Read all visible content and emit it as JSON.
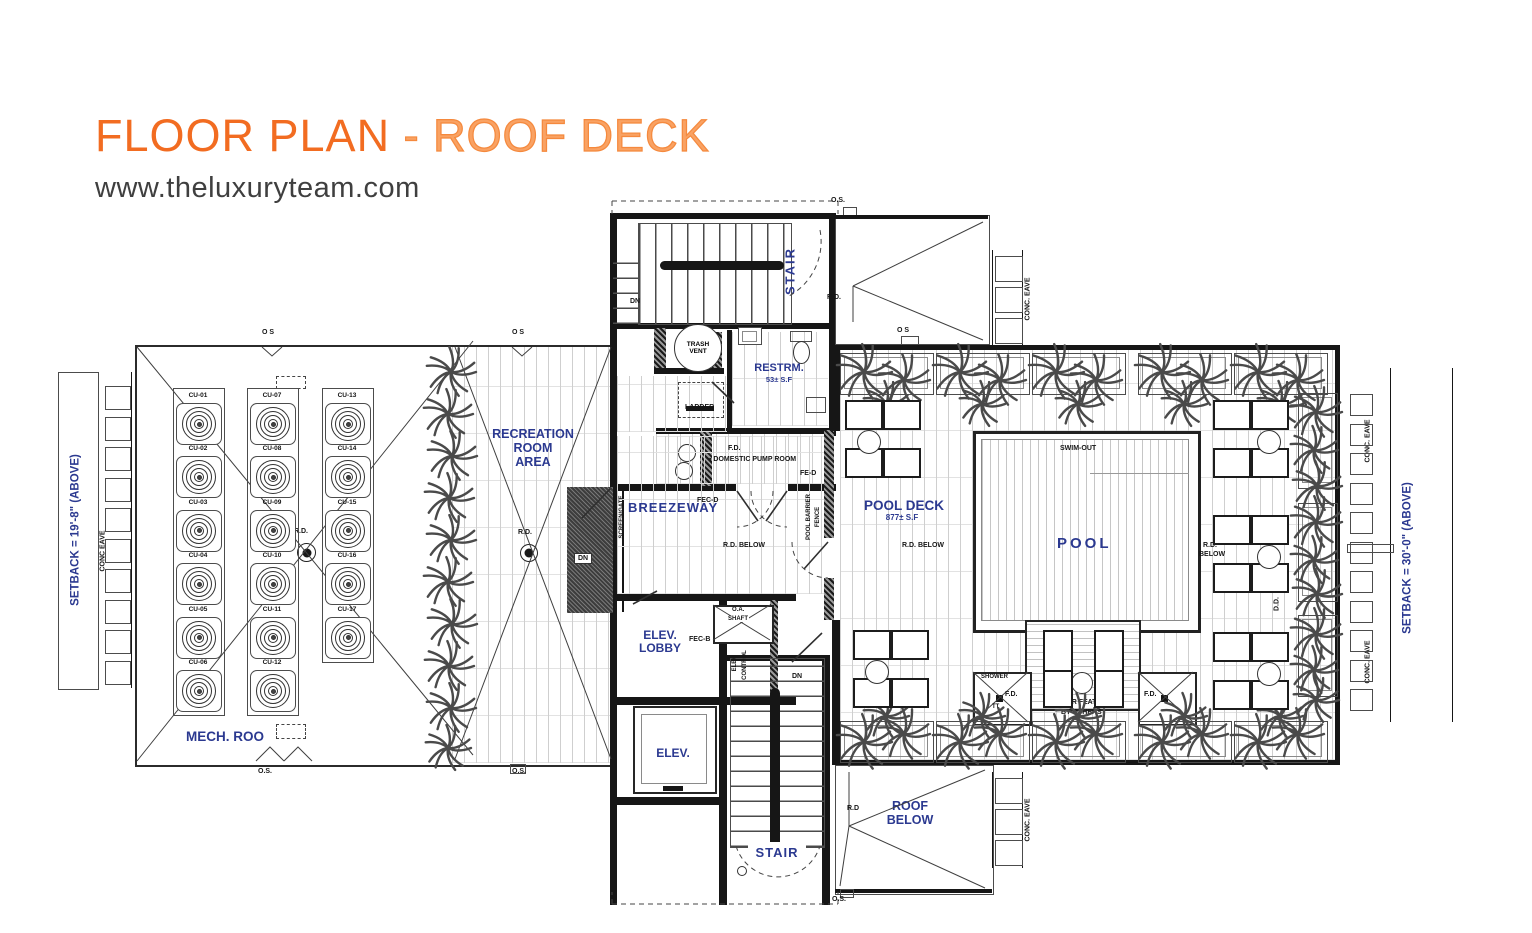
{
  "header": {
    "title_main": "FLOOR PLAN",
    "title_sub": " - ROOF DECK",
    "website": "www.theluxuryteam.com"
  },
  "colors": {
    "accent_orange": "#F26C21",
    "label_blue": "#2B3990",
    "line_dark": "#1A1A1A"
  },
  "labels": {
    "stair_top": "STAIR",
    "stair_bottom": "STAIR",
    "restrm": "RESTRM.",
    "restrm_area": "53± S.F",
    "recreation1": "RECREATION",
    "recreation2": "ROOM",
    "recreation3": "AREA",
    "breezeway": "BREEZEWAY",
    "elev_lobby1": "ELEV.",
    "elev_lobby2": "LOBBY",
    "elev": "ELEV.",
    "pool_deck": "POOL DECK",
    "pool_deck_area": "877± S.F",
    "pool": "POOL",
    "roof_below1": "ROOF",
    "roof_below2": "BELOW",
    "mech": "MECH. ROO",
    "setback_left": "SETBACK  =  19'-8\" (ABOVE)",
    "setback_right": "SETBACK = 30'-0\" (ABOVE)",
    "trash1": "TRASH",
    "trash2": "VENT"
  },
  "plan": {
    "annotations": [
      {
        "t": "O S",
        "x": 262,
        "y": 329
      },
      {
        "t": "O S",
        "x": 512,
        "y": 329
      },
      {
        "t": "O.S.",
        "x": 258,
        "y": 768
      },
      {
        "t": "O.S.",
        "x": 512,
        "y": 768
      },
      {
        "t": "R.D.",
        "x": 294,
        "y": 528
      },
      {
        "t": "R.D.",
        "x": 518,
        "y": 529
      },
      {
        "t": "DN",
        "x": 630,
        "y": 298
      },
      {
        "t": "O.S.",
        "x": 831,
        "y": 197
      },
      {
        "t": "R.D.",
        "x": 827,
        "y": 294
      },
      {
        "t": "O S",
        "x": 897,
        "y": 327
      },
      {
        "t": "CONC. EAVE",
        "cx": 1028,
        "cy": 299
      },
      {
        "t": "CONC. EAVE",
        "cx": 1028,
        "cy": 820
      },
      {
        "t": "CONC EAVE",
        "cx": 103,
        "cy": 551
      },
      {
        "t": "CONC. EAVE",
        "cx": 1368,
        "cy": 441
      },
      {
        "t": "CONC. EAVE",
        "cx": 1368,
        "cy": 662
      },
      {
        "t": "LADDER",
        "x": 685,
        "y": 404
      },
      {
        "t": "F.D.",
        "x": 728,
        "y": 445
      },
      {
        "t": "▪ DOMESTIC PUMP ROOM",
        "x": 709,
        "y": 456
      },
      {
        "t": "FE-D",
        "x": 800,
        "y": 470
      },
      {
        "t": "FEC-D",
        "x": 697,
        "y": 497
      },
      {
        "t": "R.D. BELOW",
        "x": 723,
        "y": 542
      },
      {
        "t": "SCREEN/GATE",
        "cx": 622,
        "cy": 517,
        "cls": "t6"
      },
      {
        "t": "POOL BARRIER",
        "cx": 809,
        "cy": 517,
        "cls": "t6"
      },
      {
        "t": "FENCE",
        "cx": 818,
        "cy": 517,
        "cls": "t6"
      },
      {
        "t": "DN",
        "x": 792,
        "y": 673
      },
      {
        "t": "FEC-B",
        "x": 689,
        "y": 636
      },
      {
        "t": "O.A.",
        "x": 731,
        "y": 607,
        "cls": "wbg t6"
      },
      {
        "t": "SHAFT",
        "x": 727,
        "y": 616,
        "cls": "wbg t6"
      },
      {
        "t": "ELEV.",
        "cx": 735,
        "cy": 663,
        "cls": "t6"
      },
      {
        "t": "CONTROL",
        "cx": 745,
        "cy": 665,
        "cls": "t6"
      },
      {
        "t": "DN",
        "x": 574,
        "y": 553,
        "cls": "dnb"
      },
      {
        "t": "SWIM-OUT",
        "x": 1060,
        "y": 445
      },
      {
        "t": "SHOWER",
        "x": 981,
        "y": 674,
        "cls": "t6"
      },
      {
        "t": "F.D.",
        "x": 1005,
        "y": 691
      },
      {
        "t": "TT",
        "x": 992,
        "y": 704,
        "cls": "t6"
      },
      {
        "t": "F.D.",
        "x": 1144,
        "y": 691
      },
      {
        "t": "WATER FEATURE",
        "x": 1052,
        "y": 699
      },
      {
        "t": "BY OTHERS",
        "x": 1061,
        "y": 709
      },
      {
        "t": "R.D. BELOW",
        "x": 902,
        "y": 542
      },
      {
        "t": "R.D.",
        "x": 1203,
        "y": 542
      },
      {
        "t": "BELOW",
        "x": 1199,
        "y": 551
      },
      {
        "t": "D.D.",
        "cx": 1277,
        "cy": 604
      },
      {
        "t": "R.D",
        "x": 847,
        "y": 805
      },
      {
        "t": "O.S.",
        "x": 832,
        "y": 896
      }
    ],
    "cu_units": {
      "top": 393,
      "step": 53.4,
      "w": 44,
      "h": 40,
      "columns": [
        {
          "x": 176,
          "labels": [
            "CU-01",
            "CU-02",
            "CU-03",
            "CU-04",
            "CU-05",
            "CU-06"
          ]
        },
        {
          "x": 250,
          "labels": [
            "CU-07",
            "CU-08",
            "CU-09",
            "CU-10",
            "CU-11",
            "CU-12"
          ]
        },
        {
          "x": 325,
          "labels": [
            "CU-13",
            "CU-14",
            "CU-15",
            "CU-16",
            "CU-17"
          ]
        }
      ]
    },
    "eave_tiles": [
      {
        "x": 105,
        "y": 386,
        "w": 24,
        "h": 22,
        "n": 10,
        "dy": 30.5
      },
      {
        "x": 995,
        "y": 256,
        "w": 26,
        "h": 24,
        "n": 3,
        "dy": 31
      },
      {
        "x": 995,
        "y": 778,
        "w": 26,
        "h": 24,
        "n": 3,
        "dy": 31
      },
      {
        "x": 1350,
        "y": 394,
        "w": 21,
        "h": 20,
        "n": 11,
        "dy": 29.5
      }
    ],
    "planters": {
      "top": {
        "y": 353,
        "h": 40,
        "w": 92,
        "xs": [
          840,
          936,
          1032,
          1138,
          1234
        ]
      },
      "bottom": {
        "y": 721,
        "h": 40,
        "w": 92,
        "xs": [
          840,
          936,
          1032,
          1138,
          1234
        ]
      },
      "right": {
        "x": 1298,
        "w": 38,
        "list": [
          [
            393,
            94
          ],
          [
            503,
            97
          ],
          [
            615,
            80
          ]
        ]
      }
    },
    "palms": [
      [
        451,
        372,
        50
      ],
      [
        448,
        414,
        50
      ],
      [
        452,
        456,
        50
      ],
      [
        449,
        498,
        50
      ],
      [
        451,
        540,
        50
      ],
      [
        448,
        582,
        50
      ],
      [
        452,
        624,
        50
      ],
      [
        449,
        666,
        50
      ],
      [
        451,
        708,
        50
      ],
      [
        448,
        748,
        46
      ],
      [
        864,
        372,
        56
      ],
      [
        904,
        380,
        52
      ],
      [
        886,
        404,
        46
      ],
      [
        960,
        372,
        56
      ],
      [
        1000,
        380,
        52
      ],
      [
        982,
        404,
        46
      ],
      [
        1056,
        372,
        56
      ],
      [
        1096,
        380,
        52
      ],
      [
        1078,
        404,
        46
      ],
      [
        1162,
        372,
        56
      ],
      [
        1202,
        380,
        52
      ],
      [
        1184,
        404,
        46
      ],
      [
        1258,
        372,
        56
      ],
      [
        1298,
        380,
        52
      ],
      [
        1280,
        404,
        46
      ],
      [
        864,
        742,
        56
      ],
      [
        904,
        734,
        52
      ],
      [
        886,
        716,
        46
      ],
      [
        960,
        742,
        56
      ],
      [
        1000,
        734,
        52
      ],
      [
        982,
        716,
        46
      ],
      [
        1056,
        742,
        56
      ],
      [
        1096,
        734,
        52
      ],
      [
        1078,
        716,
        46
      ],
      [
        1162,
        742,
        56
      ],
      [
        1202,
        734,
        52
      ],
      [
        1184,
        716,
        46
      ],
      [
        1258,
        742,
        56
      ],
      [
        1298,
        734,
        52
      ],
      [
        1280,
        716,
        46
      ],
      [
        1316,
        412,
        52
      ],
      [
        1314,
        450,
        48
      ],
      [
        1317,
        486,
        50
      ],
      [
        1316,
        522,
        52
      ],
      [
        1314,
        560,
        48
      ],
      [
        1317,
        594,
        50
      ],
      [
        1316,
        634,
        52
      ],
      [
        1314,
        670,
        48
      ],
      [
        1316,
        700,
        46
      ]
    ],
    "lounge_groups": [
      {
        "x": 845,
        "y": 400,
        "co": 12
      },
      {
        "x": 853,
        "y": 630,
        "co": 12
      },
      {
        "x": 1213,
        "y": 400,
        "co": 44
      },
      {
        "x": 1213,
        "y": 515,
        "co": 44
      },
      {
        "x": 1213,
        "y": 632,
        "co": 44
      }
    ],
    "water_chairs": [
      [
        1043,
        630,
        26,
        38
      ],
      [
        1094,
        630,
        26,
        38
      ],
      [
        1043,
        670,
        26,
        34
      ],
      [
        1094,
        670,
        26,
        34
      ]
    ]
  }
}
